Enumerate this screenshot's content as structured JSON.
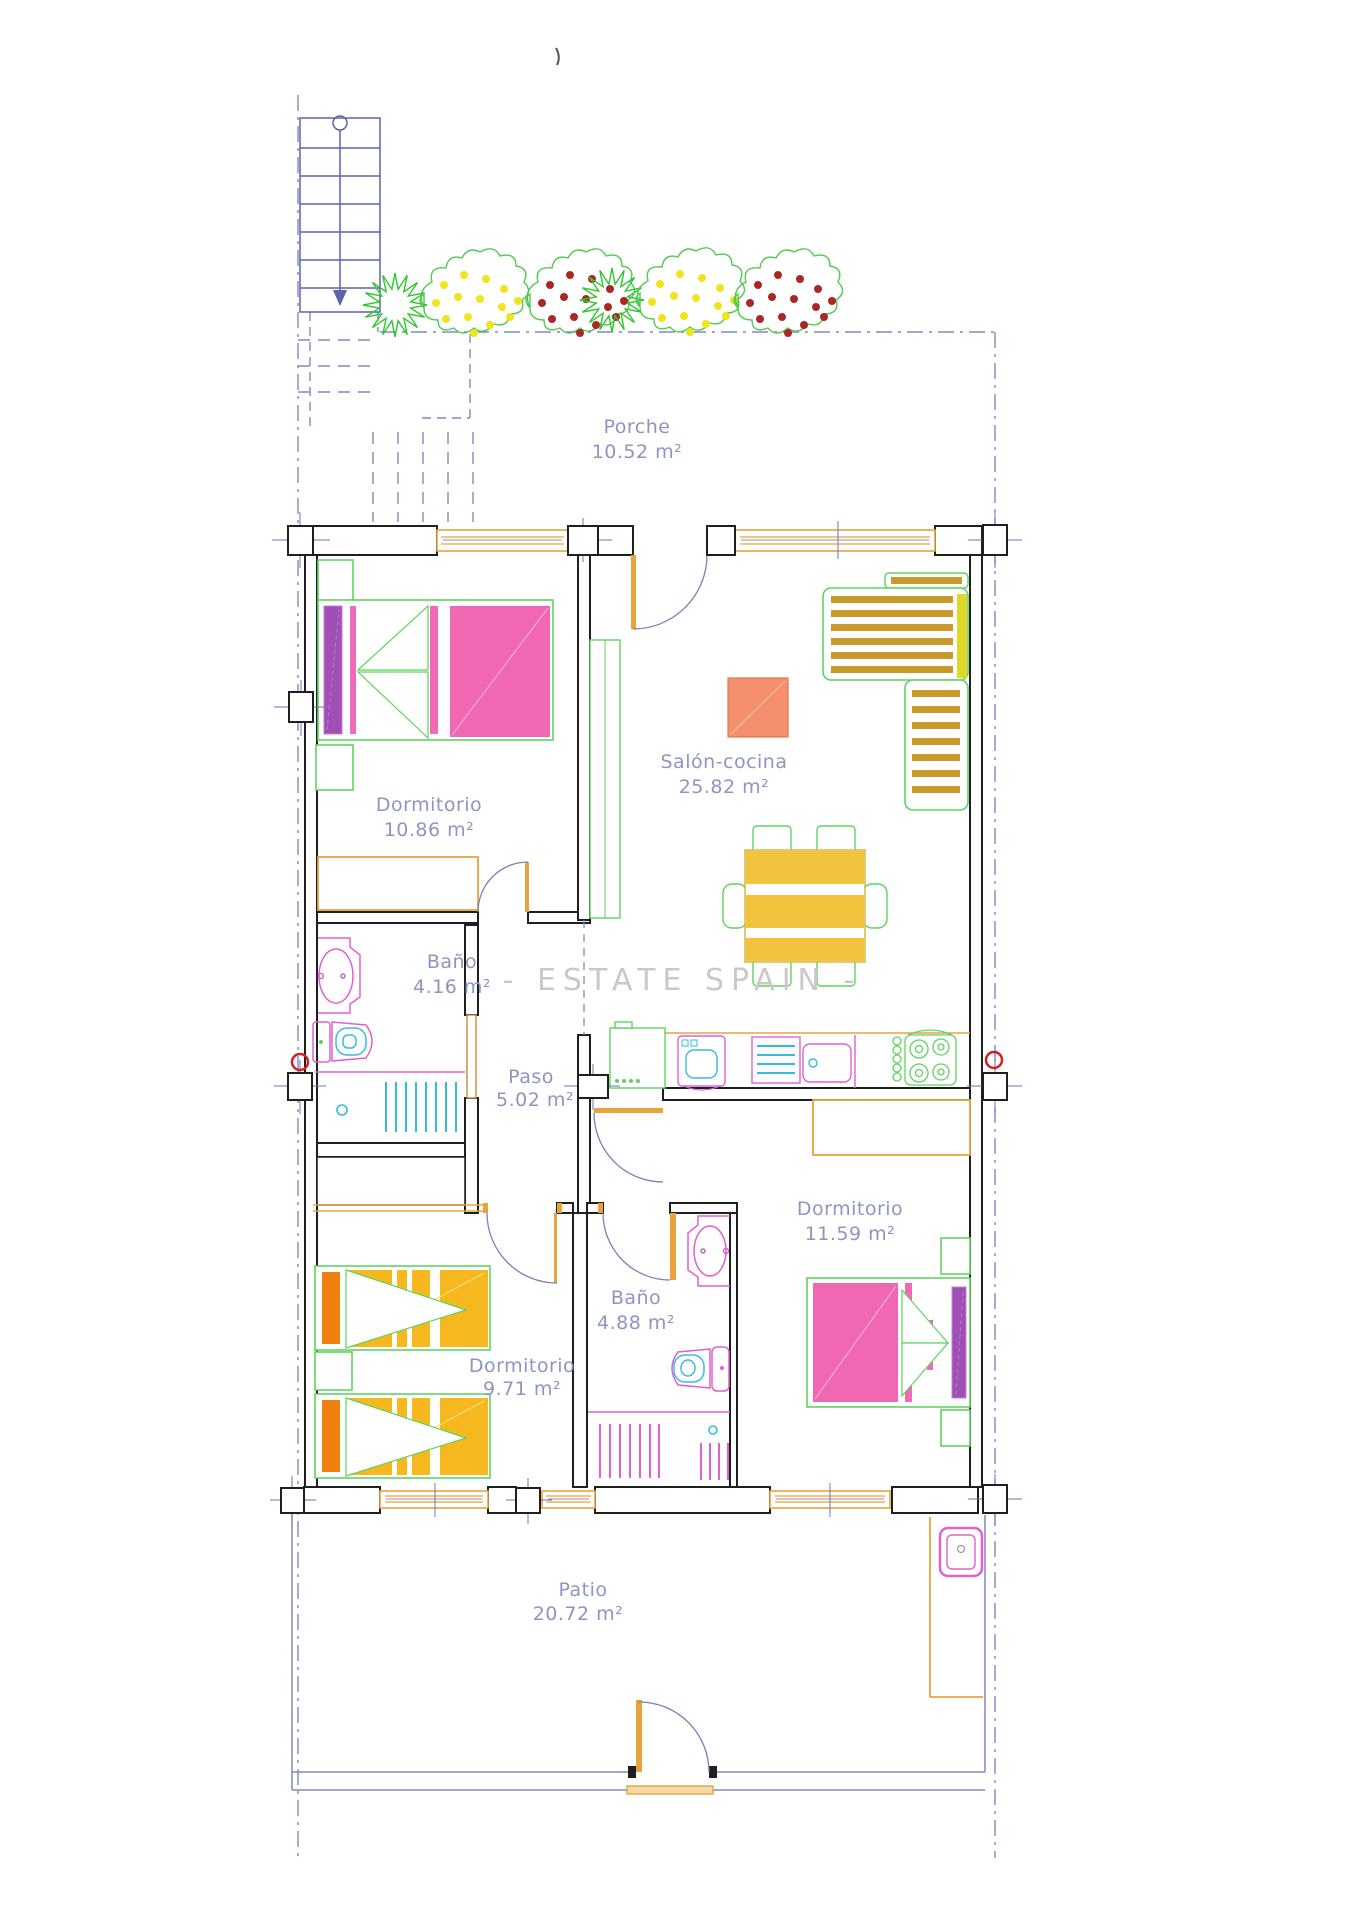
{
  "watermark": "- ESTATE SPAIN -",
  "rooms": [
    {
      "name": "Porche",
      "area": "10.52 m²"
    },
    {
      "name": "Dormitorio",
      "area": "10.86 m²"
    },
    {
      "name": "Salón-cocina",
      "area": "25.82 m²"
    },
    {
      "name": "Baño",
      "area": "4.16 m²"
    },
    {
      "name": "Paso",
      "area": "5.02 m²"
    },
    {
      "name": "Dormitorio",
      "area": "11.59 m²"
    },
    {
      "name": "Baño",
      "area": "4.88 m²"
    },
    {
      "name": "Dormitorio",
      "area": "9.71 m²"
    },
    {
      "name": "Patio",
      "area": "20.72 m²"
    }
  ],
  "palette": {
    "wall": "#1f1f1f",
    "window_door": "#e8a33d",
    "boundary": "#8289c0",
    "stairs": "#5c63a8",
    "label": "#8e95c2",
    "furniture_green": "#5fd35f",
    "bed_pink": "#f168b2",
    "pillow_purple": "#a04fb5",
    "bed_gold": "#f5b81f",
    "pillow_orange": "#f07f10",
    "sofa_stripe": "#c8992b",
    "table_gold": "#f2c33d",
    "side_table_salmon": "#f4906d",
    "fixture_magenta": "#e060d0",
    "fixture_cyan": "#35bcdc",
    "flower_yellow": "#f0e41c",
    "flower_red": "#a82828",
    "marker_red": "#cc2222",
    "watermark_gray": "#c9c9c9"
  }
}
